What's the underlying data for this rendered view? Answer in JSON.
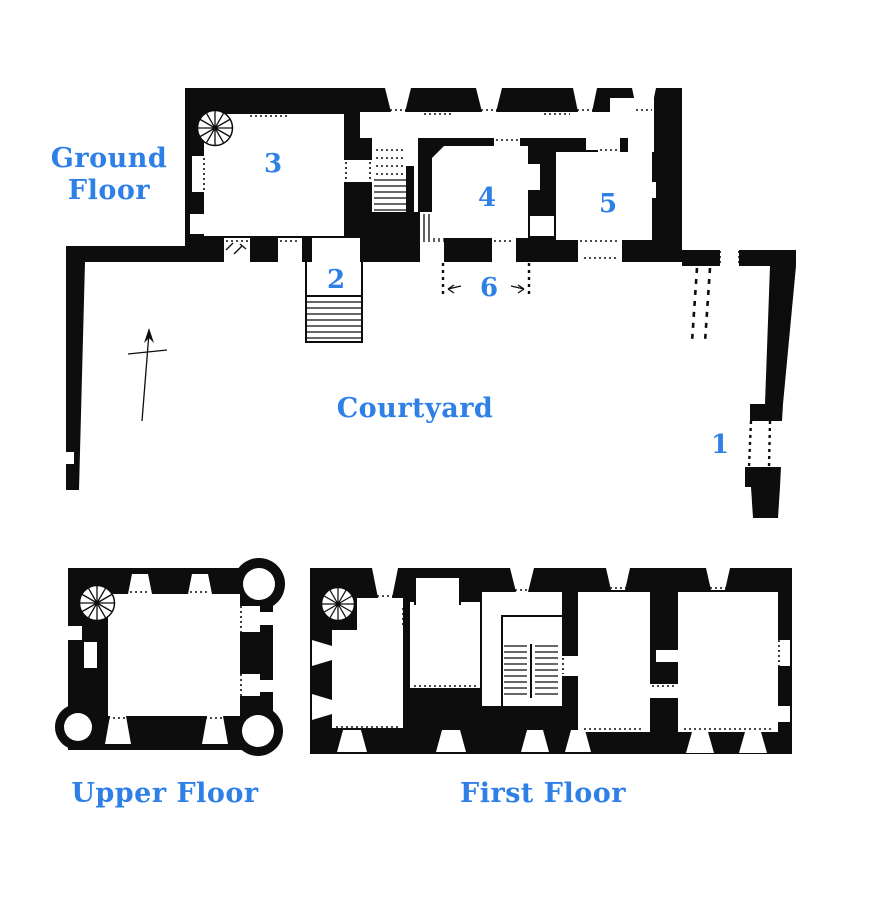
{
  "colors": {
    "label_blue": "#2e80e6",
    "ink_black": "#0d0d0d",
    "paper_white": "#ffffff"
  },
  "labels": {
    "ground_floor": "Ground Floor",
    "courtyard": "Courtyard",
    "upper_floor": "Upper Floor",
    "first_floor": "First Floor"
  },
  "rooms": {
    "r1": "1",
    "r2": "2",
    "r3": "3",
    "r4": "4",
    "r5": "5",
    "r6": "6"
  },
  "icons": {
    "spiral_stair": "circle-with-radial-spokes",
    "north_arrow": "crossed-arrow-pointing-up"
  }
}
